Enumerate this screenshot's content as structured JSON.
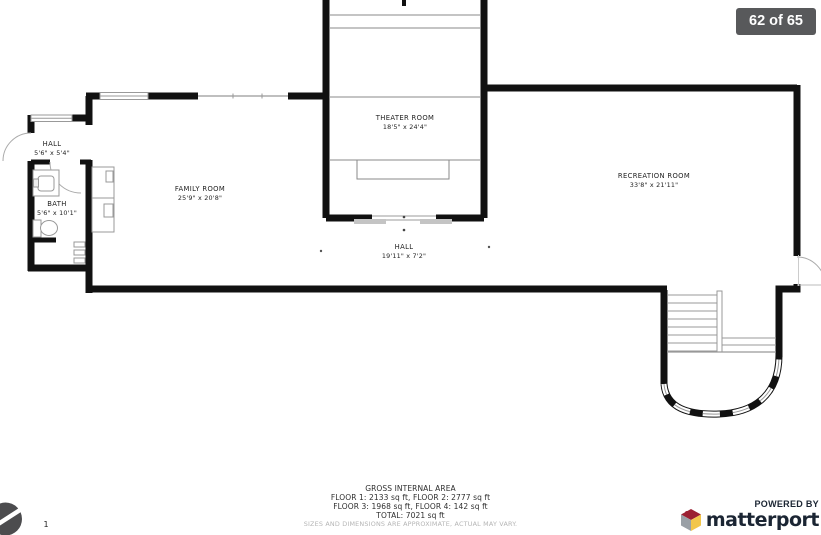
{
  "page": {
    "badge": "62 of 65"
  },
  "floorplan": {
    "rooms": [
      {
        "name": "THEATER ROOM",
        "dims": "18'5\" x 24'4\""
      },
      {
        "name": "FAMILY ROOM",
        "dims": "25'9\" x 20'8\""
      },
      {
        "name": "RECREATION ROOM",
        "dims": "33'8\" x 21'11\""
      },
      {
        "name": "HALL",
        "dims": "5'6\" x 5'4\""
      },
      {
        "name": "BATH",
        "dims": "5'6\" x 10'1\""
      },
      {
        "name": "HALL",
        "dims": "19'11\" x 7'2\""
      }
    ],
    "compass_floor_label": "1"
  },
  "area_summary": {
    "title": "GROSS INTERNAL AREA",
    "floors_line_1": "FLOOR 1: 2133 sq ft, FLOOR 2: 2777 sq ft",
    "floors_line_2": "FLOOR 3: 1968 sq ft, FLOOR 4: 142 sq ft",
    "total": "TOTAL: 7021 sq ft",
    "disclaimer": "SIZES AND DIMENSIONS ARE APPROXIMATE, ACTUAL MAY VARY."
  },
  "branding": {
    "powered_by": "POWERED BY",
    "brand_name": "matterport"
  },
  "colors": {
    "wall_black": "#111111",
    "badge_bg": "#58595b",
    "brand_navy": "#1b2533",
    "cube_red": "#9c2032",
    "cube_gray": "#9aa0a6",
    "cube_yellow": "#f2c64b",
    "disclaimer_gray": "#b5b5b5"
  }
}
